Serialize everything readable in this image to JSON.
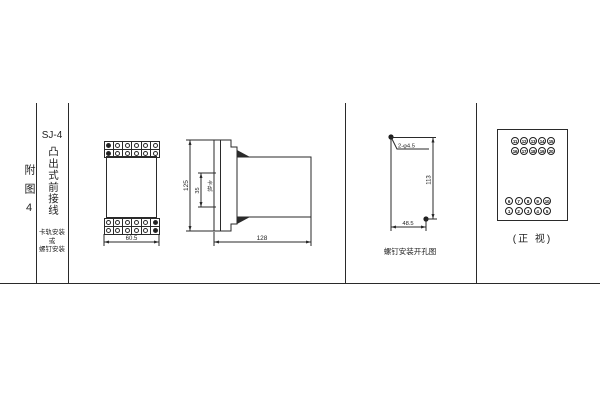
{
  "page": {
    "figure_label": "附图4",
    "model": "SJ-4",
    "title": "凸出式前接线",
    "mount_note": [
      "卡轨安装",
      "或",
      "螺钉安装"
    ]
  },
  "front_view": {
    "width_dim": "60.5"
  },
  "side_view": {
    "height_dim": "125",
    "rail_dim": "35",
    "rail_label": "卡轨",
    "depth_dim": "128"
  },
  "mounting": {
    "hole_label": "2-φ4.5",
    "vertical_dim": "113",
    "horizontal_dim": "48.5",
    "caption": "螺钉安装开孔图"
  },
  "terminals": {
    "caption": "(正 视)",
    "top_rows": [
      [
        "11",
        "12",
        "13",
        "14",
        "15"
      ],
      [
        "16",
        "17",
        "18",
        "19",
        "20"
      ]
    ],
    "bottom_rows": [
      [
        "6",
        "7",
        "8",
        "9",
        "10"
      ],
      [
        "1",
        "2",
        "3",
        "4",
        "5"
      ]
    ]
  },
  "colors": {
    "line": "#2a2a2a",
    "background": "#ffffff"
  }
}
